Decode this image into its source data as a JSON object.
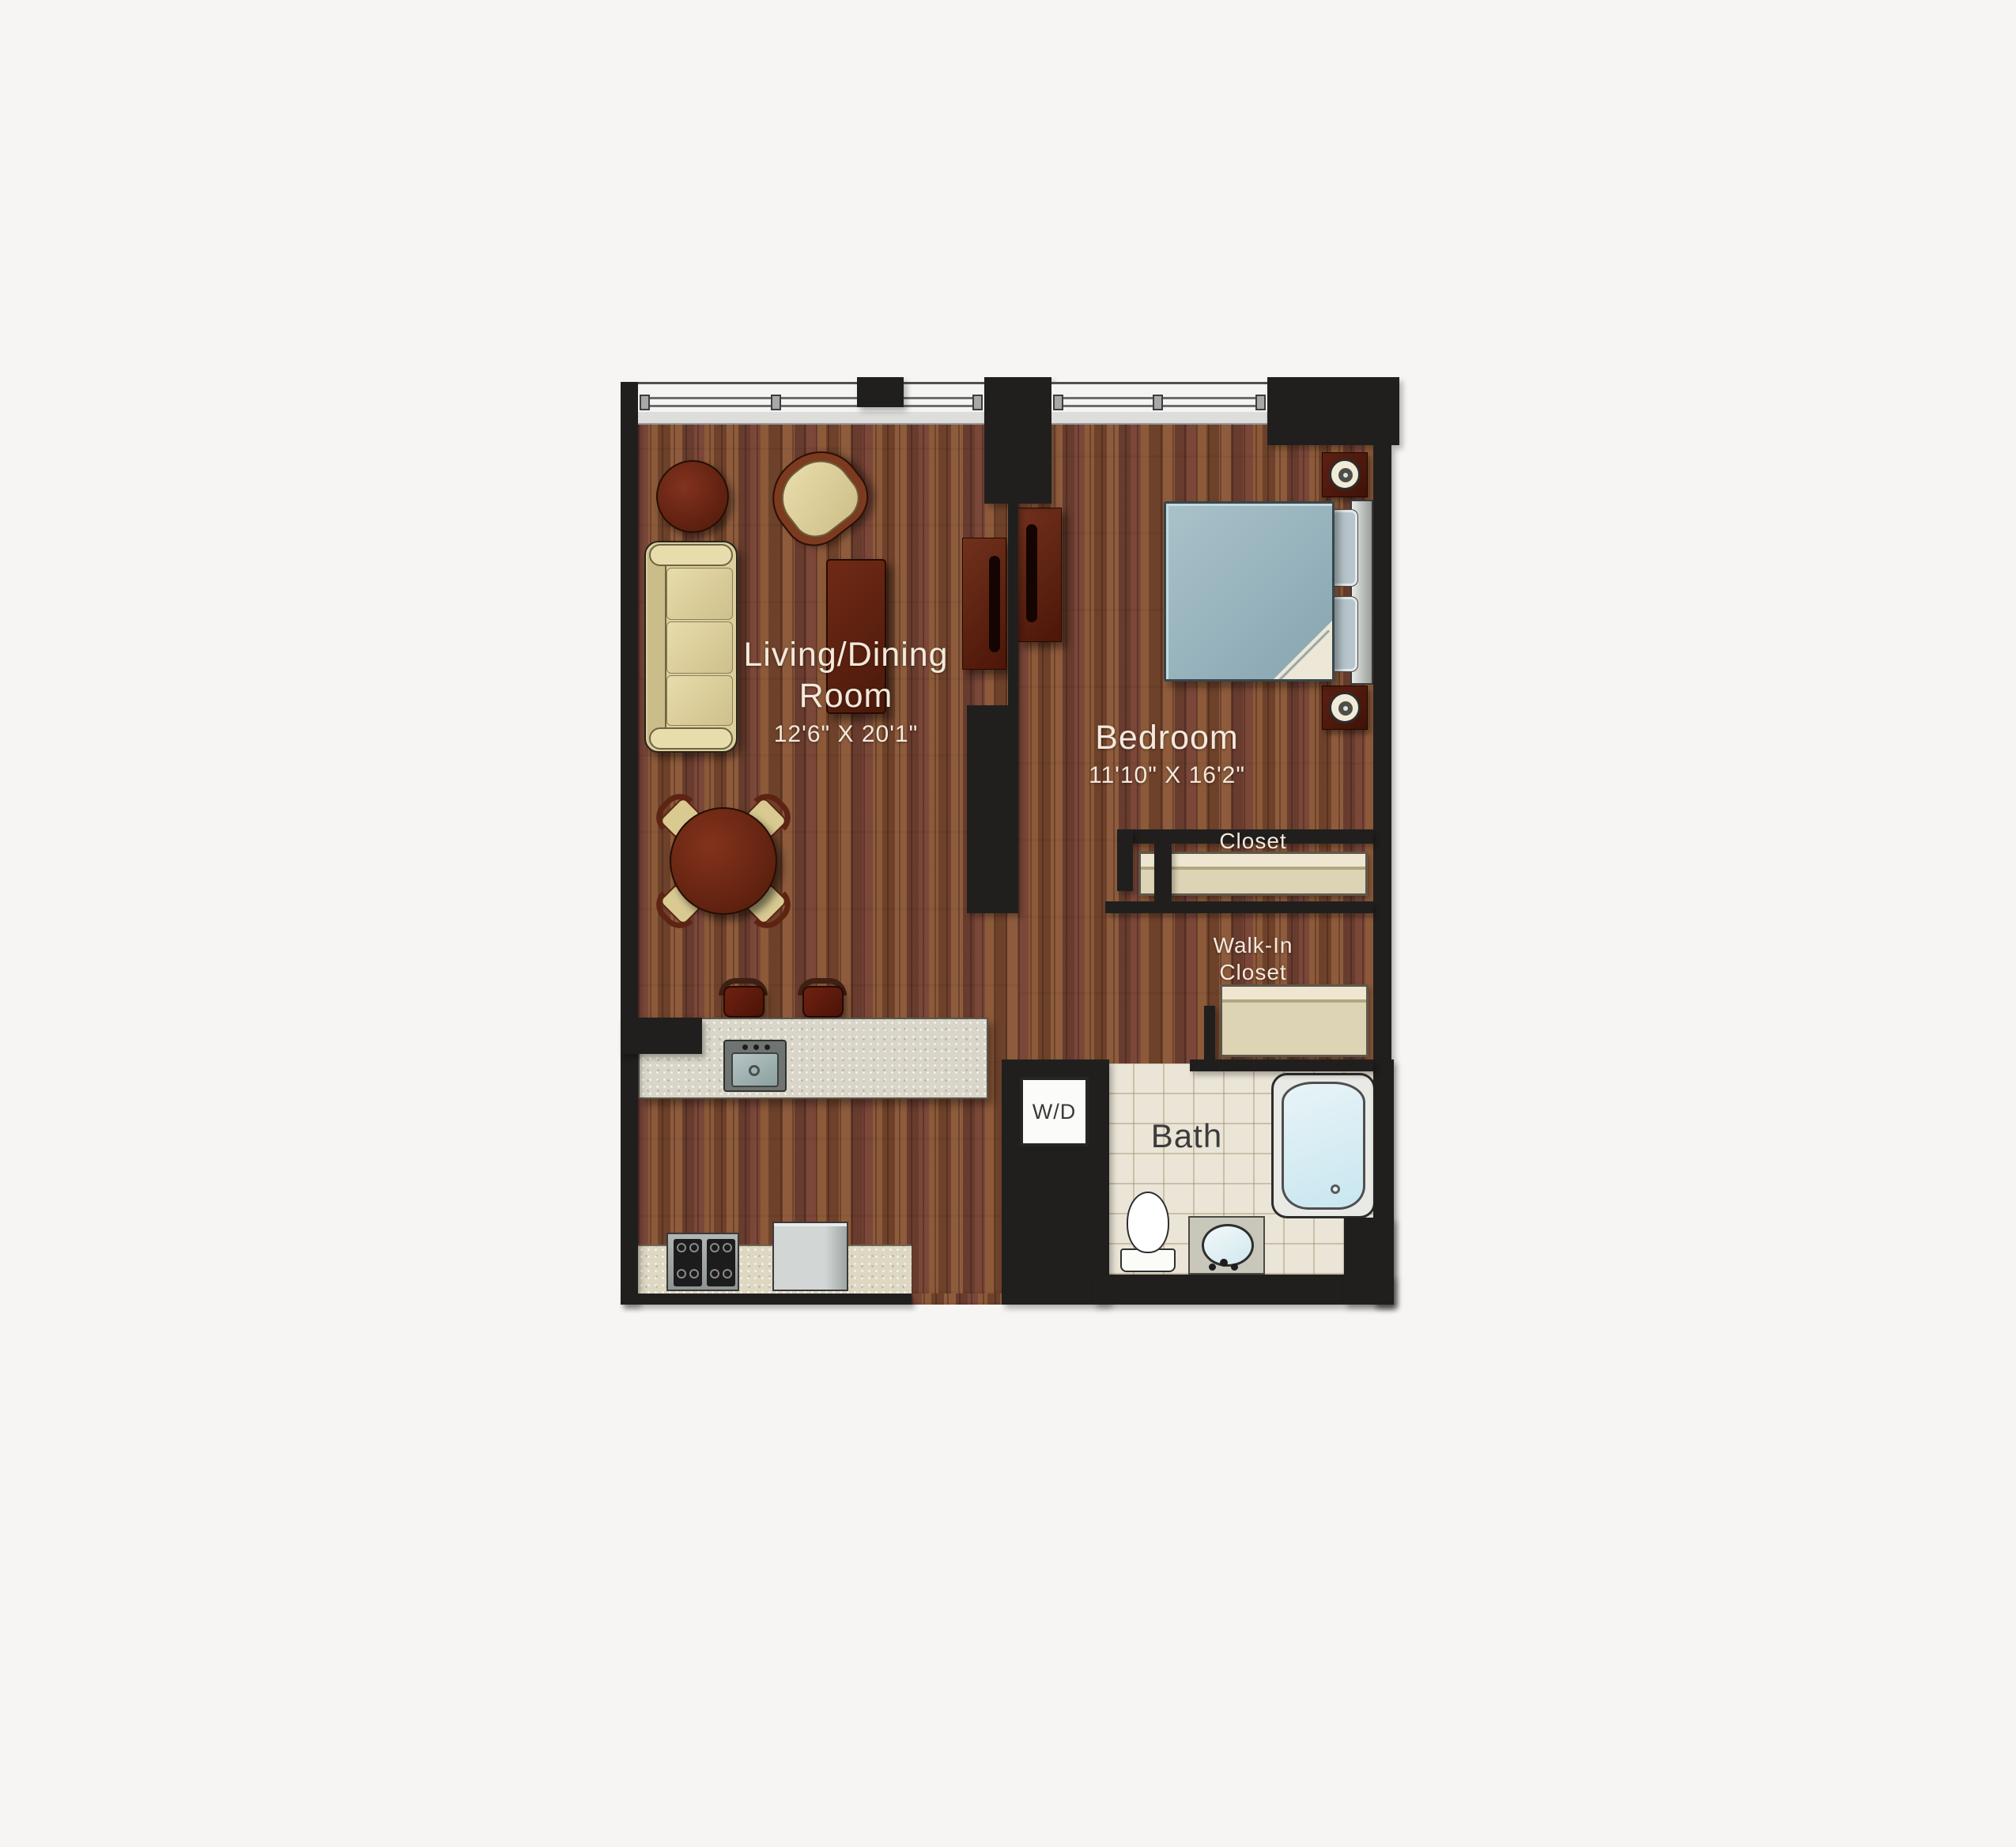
{
  "floorplan": {
    "labels": {
      "living_dining": {
        "line1": "Living/Dining",
        "line2": "Room",
        "dims": "12'6\" X 20'1\""
      },
      "bedroom": {
        "name": "Bedroom",
        "dims": "11'10\" X 16'2\""
      },
      "closet": {
        "name": "Closet"
      },
      "walk_in_closet": {
        "line1": "Walk-In",
        "line2": "Closet"
      },
      "bath": {
        "name": "Bath"
      },
      "washer_dryer": {
        "label": "W/D"
      }
    },
    "colors": {
      "background": "#f6f5f3",
      "wall": "#201f1e",
      "wood_floor": "#7d4e33",
      "window": "#f4f4f3",
      "bath_tile": "#ebe5d7",
      "closet_shelf": "#ddd3b5",
      "duvet": "#93aeb9",
      "tub_water": "#cfe9f2",
      "island_counter": "#d9d6c9",
      "upholstery": "#dccf9e",
      "dark_wood_furniture": "#5c2010",
      "label_text": "#f3e9dc"
    },
    "fixtures": [
      "windows",
      "sofa",
      "armchair",
      "side-table",
      "coffee-table",
      "media-consoles",
      "dining-table",
      "dining-chairs",
      "kitchen-island",
      "island-sink",
      "bar-stools",
      "stove",
      "refrigerator",
      "kitchen-counter",
      "bed",
      "duvet",
      "pillows",
      "headboard",
      "nightstands",
      "lamps",
      "closet-shelf",
      "walk-in-shelf",
      "washer-dryer",
      "bathtub",
      "toilet",
      "vanity-sink"
    ]
  }
}
